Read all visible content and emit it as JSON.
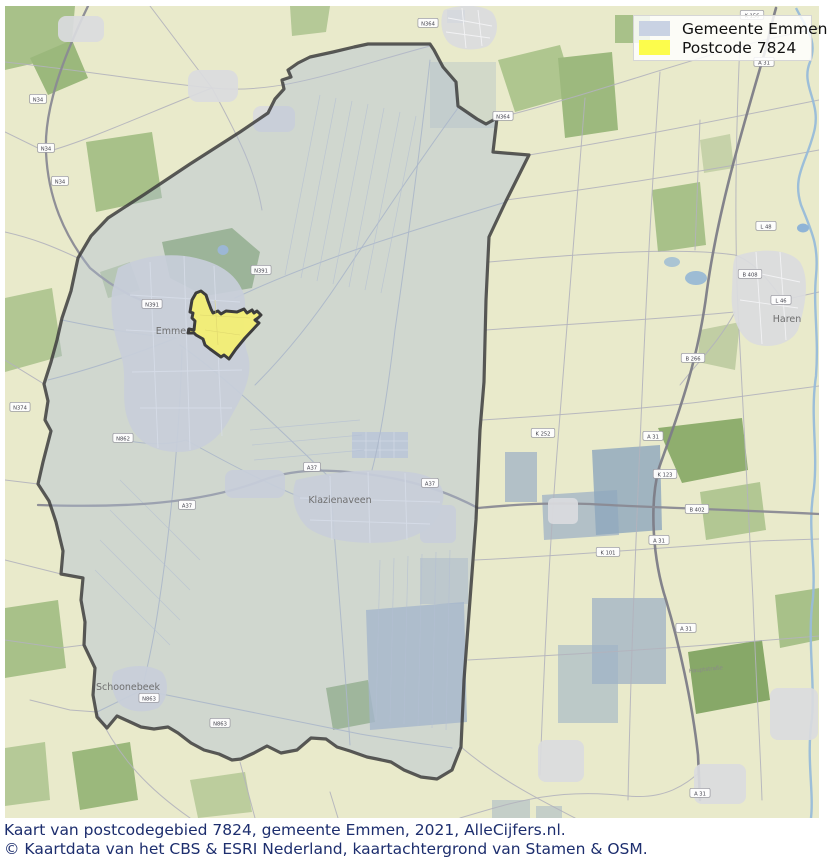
{
  "legend": {
    "items": [
      {
        "label": "Gemeente Emmen",
        "color": "#c9d2e3"
      },
      {
        "label": "Postcode 7824",
        "color": "#fcfc4c"
      }
    ]
  },
  "caption": {
    "line1": "Kaart van postcodegebied 7824, gemeente Emmen, 2021, AlleCijfers.nl.",
    "line2": "© Kaartdata van het CBS & ESRI Nederland, kaartachtergrond van Stamen & OSM."
  },
  "map": {
    "towns": [
      {
        "name": "Emmen",
        "x": 174,
        "y": 334
      },
      {
        "name": "Klazienaveen",
        "x": 340,
        "y": 503
      },
      {
        "name": "Schoonebeek",
        "x": 128,
        "y": 690
      },
      {
        "name": "Haren",
        "x": 787,
        "y": 322
      }
    ],
    "street_labels": [
      {
        "label": "Hauptstraße",
        "x": 706,
        "y": 671,
        "angle": -6
      }
    ],
    "road_badges": [
      {
        "label": "N34",
        "x": 38,
        "y": 99
      },
      {
        "label": "N34",
        "x": 46,
        "y": 148
      },
      {
        "label": "N34",
        "x": 60,
        "y": 181
      },
      {
        "label": "N374",
        "x": 20,
        "y": 407
      },
      {
        "label": "N391",
        "x": 152,
        "y": 304
      },
      {
        "label": "N391",
        "x": 261,
        "y": 270
      },
      {
        "label": "N862",
        "x": 123,
        "y": 438
      },
      {
        "label": "A37",
        "x": 187,
        "y": 505
      },
      {
        "label": "A37",
        "x": 312,
        "y": 467
      },
      {
        "label": "A37",
        "x": 430,
        "y": 483
      },
      {
        "label": "B 402",
        "x": 697,
        "y": 509
      },
      {
        "label": "A 31",
        "x": 764,
        "y": 62
      },
      {
        "label": "A 31",
        "x": 653,
        "y": 436
      },
      {
        "label": "A 31",
        "x": 659,
        "y": 540
      },
      {
        "label": "A 31",
        "x": 686,
        "y": 628
      },
      {
        "label": "A 31",
        "x": 700,
        "y": 793
      },
      {
        "label": "K 156",
        "x": 752,
        "y": 15
      },
      {
        "label": "B 408",
        "x": 750,
        "y": 274
      },
      {
        "label": "L 46",
        "x": 781,
        "y": 300
      },
      {
        "label": "L 48",
        "x": 766,
        "y": 226
      },
      {
        "label": "B 266",
        "x": 693,
        "y": 358
      },
      {
        "label": "N863",
        "x": 149,
        "y": 698
      },
      {
        "label": "N863",
        "x": 220,
        "y": 723
      },
      {
        "label": "N364",
        "x": 428,
        "y": 23
      },
      {
        "label": "N364",
        "x": 503,
        "y": 116
      },
      {
        "label": "K 252",
        "x": 543,
        "y": 433
      },
      {
        "label": "K 123",
        "x": 665,
        "y": 474
      },
      {
        "label": "K 101",
        "x": 608,
        "y": 552
      }
    ],
    "colors": {
      "background": "#e9eacb",
      "municipality_fill": "#aebdd3",
      "municipality_outline": "#3e3e3e",
      "postcode_fill": "#f3ee74",
      "postcode_outline": "#3d3d3d",
      "water": "#98bcd9"
    }
  }
}
